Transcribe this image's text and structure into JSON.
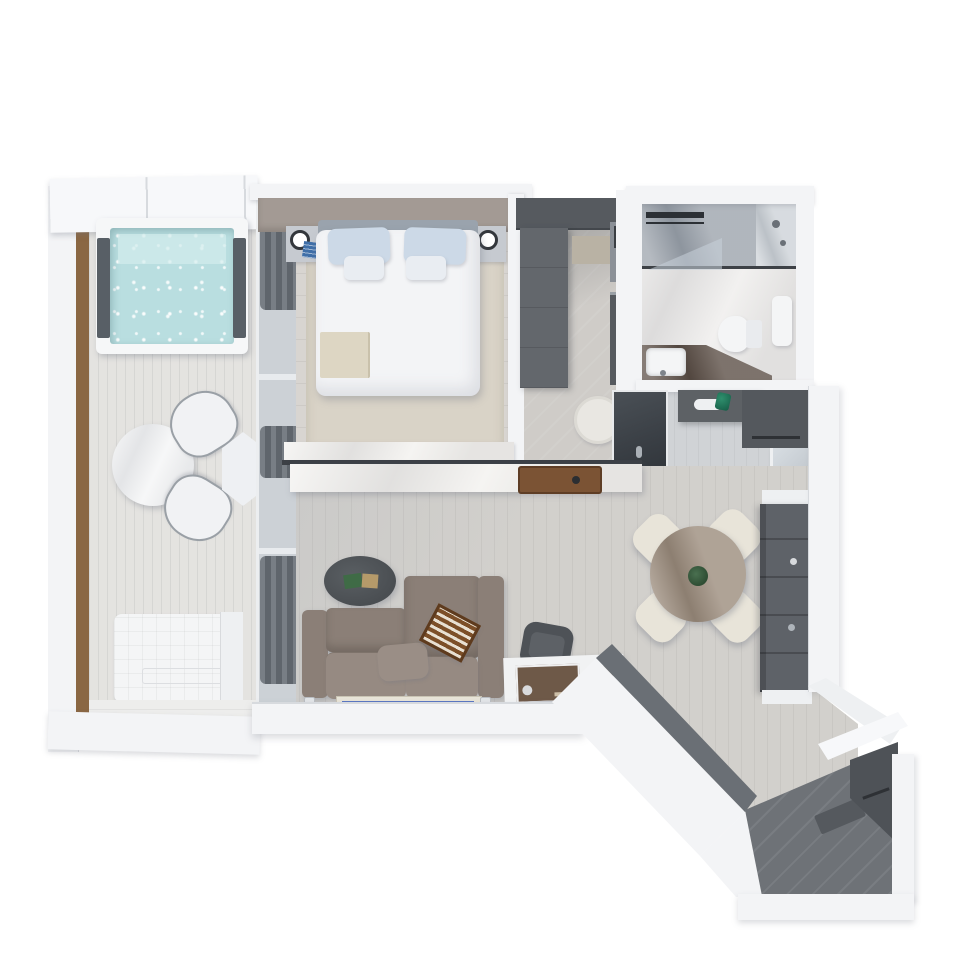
{
  "meta": {
    "kind": "3d-floorplan-top-down-render",
    "visible_text": "none"
  },
  "palette": {
    "bg": "#ffffff",
    "wall": "#f3f4f6",
    "wall_bright": "#f7f8fa",
    "wall_edge": "#d7dade",
    "wall_dark": "#6a6f75",
    "deck": "#e4e3e0",
    "deck_bottom": "#ededec",
    "wood_beam": "#8a6743",
    "pool_frame": "#f6f7f8",
    "pool_water": "#b9dee0",
    "pool_water_hi": "#d3ecec",
    "pool_pad": "#585f66",
    "glass_band": "#ccd1d6",
    "curtain_a": "#787e85",
    "curtain_b": "#5f656c",
    "headboard_wall": "#a39a94",
    "bedroom_floor": "#d8d5d1",
    "rug_beige": "#d9d3c7",
    "bed_white": "#f3f4f6",
    "bed_head": "#9aa3ad",
    "pillow_blue": "#ccd9e7",
    "pillow_white": "#e9edf2",
    "throw_beige": "#ddd6c3",
    "nightstand": "#c6cad0",
    "lamp_ring": "#33373c",
    "books_blue": "#3f6fa8",
    "wardrobe": "#63676c",
    "wardrobe_dark": "#565a5f",
    "cab_light": "#8b9097",
    "shelf_tan": "#b9b2a4",
    "stool": "#e9e7e2",
    "door_glass": "#3a3f45",
    "bath_floor": "#e7e5e3",
    "shower_marble": "#8e96a0",
    "shower_panel": "#c6ccd2",
    "glass_dark": "#3d4146",
    "vanity_dark": "#45362c",
    "white_fix": "#f4f5f6",
    "hall_floor": "#d0d3d6",
    "console_dark": "#5d6165",
    "green_glass": "#155c46",
    "mirror": "#c3c9cf",
    "marble_top": "#edebe7",
    "tray_brown": "#7b5334",
    "living_floor": "#d2d0cc",
    "sofa": "#8b7f77",
    "sofa_light": "#968a82",
    "coffee_table": "#4a4e52",
    "book_green": "#3f6b46",
    "book_tan": "#b59a6a",
    "backgammon": "#7c4f28",
    "backgammon_stripe": "#e8e0d2",
    "rug_border": "#e8e4d8",
    "rug_blue": "#5a77c2",
    "rug_medallion": "#cfd8ee",
    "chair_dark": "#4e5257",
    "desk_white": "#f1f2f3",
    "radio_brown": "#6e5948",
    "sphere_hi": "#7a5f3c",
    "sphere_lo": "#4c3a24",
    "dining_table": "#8d7b69",
    "dining_chair": "#e8e4d9",
    "plant": "#2e4d33",
    "shelf_unit": "#5e6268",
    "entry_floor": "#6e7277",
    "bench_dark": "#4e5257",
    "mat": "#55595e",
    "shadow": "rgba(110,116,128,0.35)"
  },
  "scene": {
    "rooms": [
      {
        "name": "balcony",
        "items": [
          "pergola-roof",
          "plunge-pool",
          "outdoor-dining-table",
          "outdoor-chair",
          "outdoor-chair",
          "hex-side-table",
          "daybed-lounger",
          "wood-beam"
        ]
      },
      {
        "name": "bedroom",
        "items": [
          "double-bed",
          "blue-pillows",
          "white-pillows",
          "throw-blanket",
          "nightstand-left",
          "nightstand-right",
          "table-lamp",
          "table-lamp",
          "blue-books",
          "area-rug",
          "curtains",
          "headboard-wall"
        ]
      },
      {
        "name": "walk-in-closet",
        "items": [
          "wardrobe",
          "overhead-cabinet",
          "shelf-box",
          "side-cabinets",
          "dressing-stool",
          "bathroom-door"
        ]
      },
      {
        "name": "bathroom",
        "items": [
          "walk-in-shower",
          "towel-rail",
          "glass-screen",
          "shower-fixtures",
          "toilet",
          "hand-shower",
          "vanity-counter",
          "sink"
        ]
      },
      {
        "name": "hallway",
        "items": [
          "console-cabinet",
          "decor-dish",
          "green-glass-vase",
          "drawer-unit",
          "mirror-panel"
        ]
      },
      {
        "name": "living-room",
        "items": [
          "sectional-sofa",
          "lumbar-pillow",
          "backgammon-board",
          "oval-coffee-table",
          "decor-books",
          "blue-runner-rug",
          "marble-media-console",
          "leather-tray",
          "desk",
          "desk-chair",
          "speaker",
          "decor-sphere",
          "paper-tray"
        ]
      },
      {
        "name": "dining-area",
        "items": [
          "round-marble-table",
          "dining-chair",
          "dining-chair",
          "dining-chair",
          "dining-chair",
          "plant-centerpiece",
          "shelving-unit"
        ]
      },
      {
        "name": "entry",
        "items": [
          "diagonal-corridor",
          "entry-bench",
          "door-mat"
        ]
      }
    ]
  }
}
